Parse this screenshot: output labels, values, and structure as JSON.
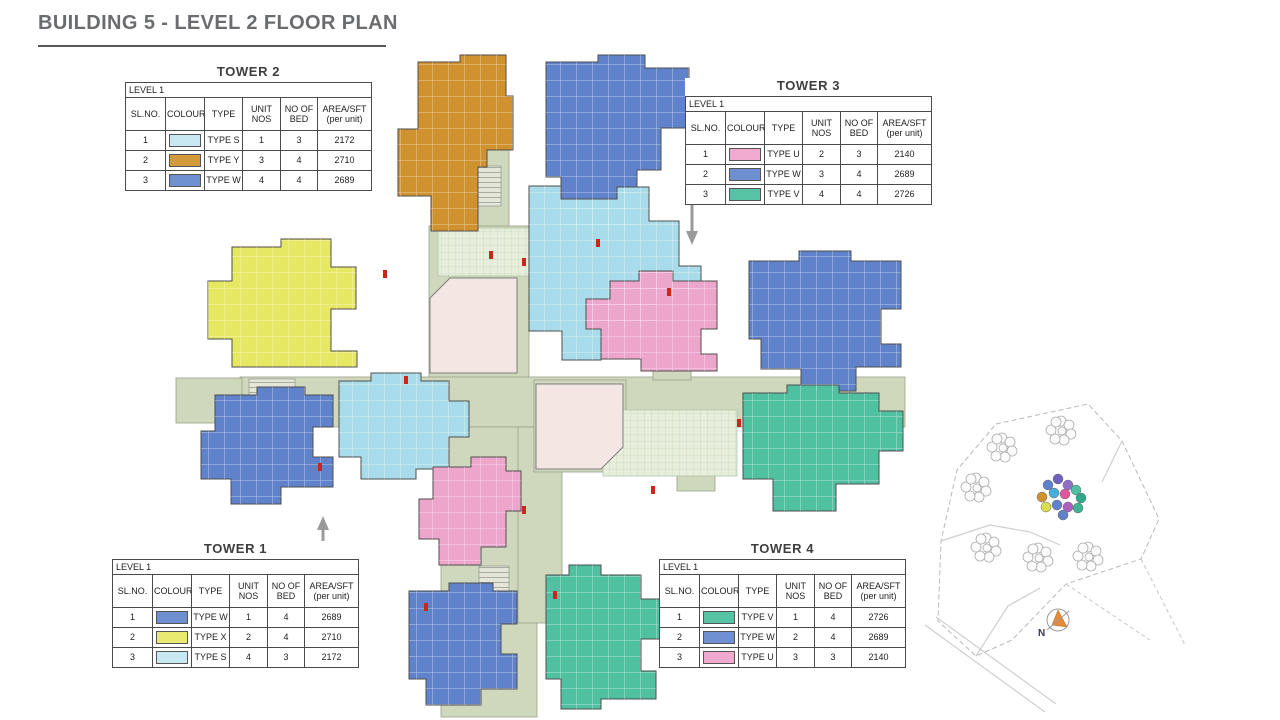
{
  "page": {
    "title": "BUILDING 5 - LEVEL 2 FLOOR PLAN"
  },
  "legend_columns": [
    "SL.NO.",
    "COLOUR",
    "TYPE",
    "UNIT NOS",
    "NO OF BED",
    "AREA/SFT (per unit)"
  ],
  "towers": {
    "tower1": {
      "name": "TOWER 1",
      "level": "LEVEL 1",
      "rows": [
        {
          "sl": "1",
          "color": "#6e8fd0",
          "type": "TYPE W",
          "units": "1",
          "beds": "4",
          "area": "2689"
        },
        {
          "sl": "2",
          "color": "#e9ea71",
          "type": "TYPE X",
          "units": "2",
          "beds": "4",
          "area": "2710"
        },
        {
          "sl": "3",
          "color": "#c9e9f2",
          "type": "TYPE S",
          "units": "4",
          "beds": "3",
          "area": "2172"
        }
      ]
    },
    "tower2": {
      "name": "TOWER 2",
      "level": "LEVEL 1",
      "rows": [
        {
          "sl": "1",
          "color": "#c9e9f2",
          "type": "TYPE S",
          "units": "1",
          "beds": "3",
          "area": "2172"
        },
        {
          "sl": "2",
          "color": "#d29a3a",
          "type": "TYPE Y",
          "units": "3",
          "beds": "4",
          "area": "2710"
        },
        {
          "sl": "3",
          "color": "#6e8fd0",
          "type": "TYPE W",
          "units": "4",
          "beds": "4",
          "area": "2689"
        }
      ]
    },
    "tower3": {
      "name": "TOWER 3",
      "level": "LEVEL 1",
      "rows": [
        {
          "sl": "1",
          "color": "#f0a9cf",
          "type": "TYPE U",
          "units": "2",
          "beds": "3",
          "area": "2140"
        },
        {
          "sl": "2",
          "color": "#6e8fd0",
          "type": "TYPE W",
          "units": "3",
          "beds": "4",
          "area": "2689"
        },
        {
          "sl": "3",
          "color": "#56c3a4",
          "type": "TYPE V",
          "units": "4",
          "beds": "4",
          "area": "2726"
        }
      ]
    },
    "tower4": {
      "name": "TOWER 4",
      "level": "LEVEL 1",
      "rows": [
        {
          "sl": "1",
          "color": "#56c3a4",
          "type": "TYPE V",
          "units": "1",
          "beds": "4",
          "area": "2726"
        },
        {
          "sl": "2",
          "color": "#6e8fd0",
          "type": "TYPE W",
          "units": "2",
          "beds": "4",
          "area": "2689"
        },
        {
          "sl": "3",
          "color": "#f0a9cf",
          "type": "TYPE U",
          "units": "3",
          "beds": "3",
          "area": "2140"
        }
      ]
    }
  },
  "plan_colors": {
    "type_s": "#a9dcea",
    "type_y": "#d0922f",
    "type_w": "#5f82cb",
    "type_u": "#eda6cb",
    "type_v": "#4fc0a0",
    "type_x": "#e6e763",
    "corridor": "#cfd8bd",
    "hatch": "#e7efdc",
    "hall": "#f3e6e3",
    "door": "#c9271d",
    "arrow": "#9a9a9a"
  },
  "site_map": {
    "north_label": "N"
  }
}
